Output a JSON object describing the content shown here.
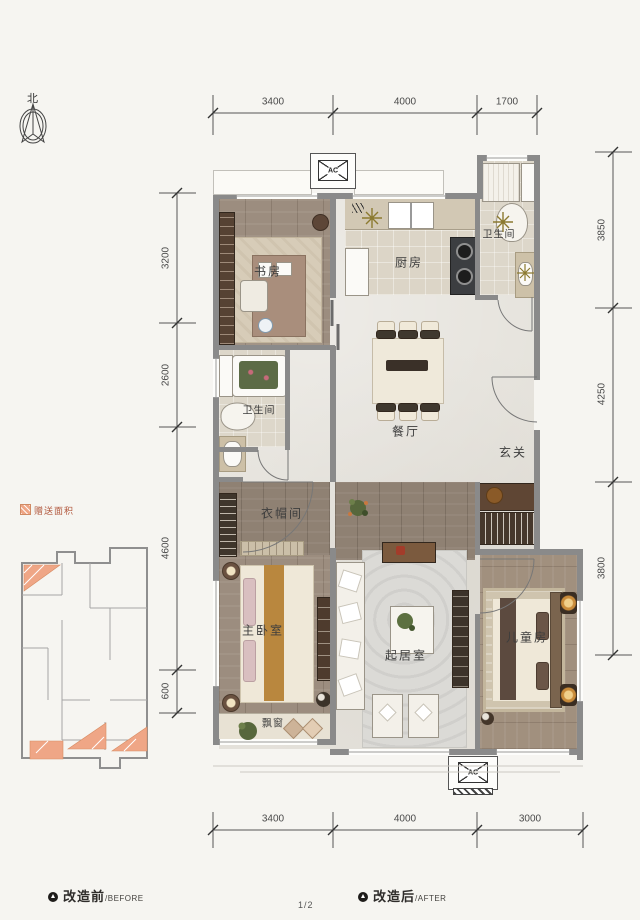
{
  "compass": {
    "label": "北"
  },
  "page": {
    "number": "1/2"
  },
  "legend": {
    "bonus_label": "赠送面积"
  },
  "captions": {
    "before_zh": "改造前",
    "before_en": "/BEFORE",
    "after_zh": "改造后",
    "after_en": "/AFTER"
  },
  "ac": {
    "top": "AC",
    "bottom": "AC"
  },
  "rooms": {
    "study": "书房",
    "kitchen": "厨房",
    "bath_top": "卫生间",
    "bath_mid": "卫生间",
    "dining": "餐厅",
    "foyer": "玄关",
    "cloakroom": "衣帽间",
    "master": "主卧室",
    "living": "起居室",
    "kids": "儿童房",
    "bay": "飘窗"
  },
  "dimensions": {
    "top": [
      "3400",
      "4000",
      "1700"
    ],
    "bottom": [
      "3400",
      "4000",
      "3000"
    ],
    "left": [
      "3200",
      "2600",
      "4600",
      "600"
    ],
    "right": [
      "3850",
      "4250",
      "3800"
    ]
  },
  "colors": {
    "wall": "#8a8a8a",
    "accent": "#efa686",
    "legend_text": "#b2593f"
  }
}
